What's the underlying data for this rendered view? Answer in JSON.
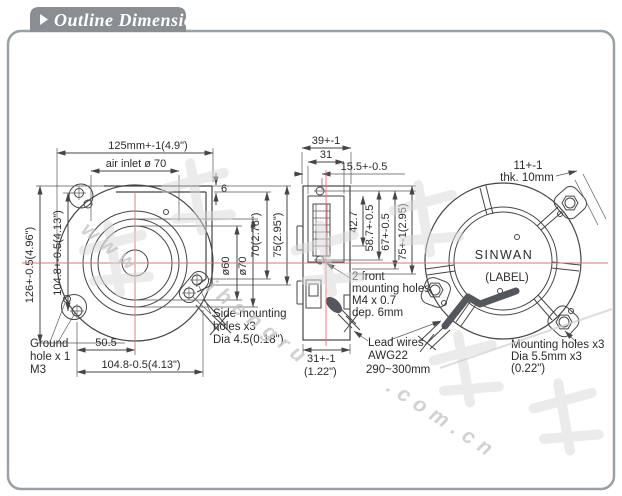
{
  "header": {
    "title": "Outline Dimensions"
  },
  "front_view": {
    "width": "125mm+-1(4.9\")",
    "air_inlet": "air inlet ø 70",
    "step": "6",
    "outlet_inner": "70(2.76\")",
    "outlet_outer": "75(2.95\")",
    "d60": "ø60",
    "d70": "ø70",
    "height": "126+-0.5(4.96\")",
    "hole_span_left": "104.8+-0.5(4.13\")",
    "center_offset": "50.5",
    "hole_span_bottom": "104.8-0.5(4.13\")",
    "ground_hole": [
      "Ground",
      "hole x 1",
      "M3"
    ],
    "side_mounting": [
      "Side mounting",
      "holes x3",
      "Dia 4.5(0.18\")"
    ]
  },
  "side_view": {
    "depth": "39+-1",
    "inner_depth": "31",
    "hole_offset": "15.5+-0.5",
    "d1": "42.7",
    "d2": "58.7+-0.5",
    "d3": "67+-0.5",
    "d4": "75+-1(2.95)",
    "front_holes": [
      "2 front",
      "mounting holes",
      "M4 x 0.7",
      "dep. 6mm"
    ],
    "bottom_depth": [
      "31+-1",
      "(1.22\")"
    ],
    "lead_wires": [
      "Lead wires",
      "AWG22",
      "290~300mm"
    ]
  },
  "rear_view": {
    "thickness": [
      "11+-1",
      "thk. 10mm"
    ],
    "brand": "SINWAN",
    "label": "(LABEL)",
    "mounting": [
      "Mounting holes x3",
      "Dia 5.5mm x3",
      "(0.22\")"
    ]
  },
  "watermark": {
    "seg1": "www",
    "seg2": "ihengru",
    "seg3": ".com.cn"
  },
  "colors": {
    "centerline": "#e57373",
    "tab": "#8a8e93",
    "frame": "#9aa0a4",
    "line": "#454545",
    "wire": "#54585c",
    "watermark": "#d7d7d7"
  }
}
